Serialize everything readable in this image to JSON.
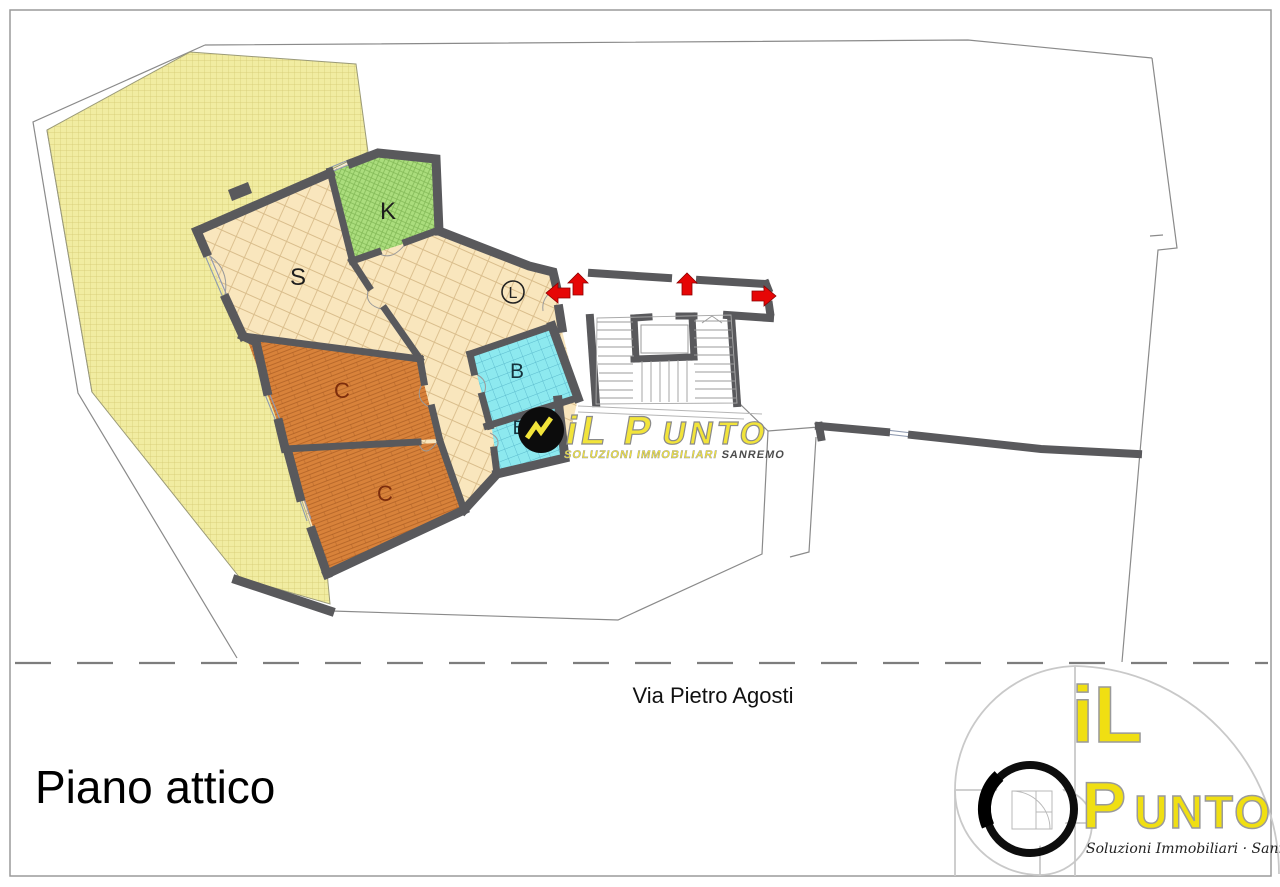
{
  "page": {
    "title": "Piano attico",
    "street": "Via Pietro Agosti"
  },
  "plan": {
    "colors": {
      "wall": "#59595c",
      "outline": "#8a8a8a",
      "arrow": "#e60606",
      "hall": "#f9e6bd"
    },
    "rooms": [
      {
        "id": "terrace",
        "label": "",
        "color": "#f1eca1",
        "label_color": "#333333"
      },
      {
        "id": "soggiorno",
        "label": "S",
        "color": "#f9e6bd",
        "label_color": "#1d1d1d"
      },
      {
        "id": "cucina",
        "label": "K",
        "color": "#abdd7d",
        "label_color": "#1d1d1d"
      },
      {
        "id": "camera-1",
        "label": "C",
        "color": "#d8823a",
        "label_color": "#7c2d0c"
      },
      {
        "id": "camera-2",
        "label": "C",
        "color": "#d8823a",
        "label_color": "#7c2d0c"
      },
      {
        "id": "bagno-1",
        "label": "B",
        "color": "#8de9ef",
        "label_color": "#15333d"
      },
      {
        "id": "bagno-2",
        "label": "B",
        "color": "#8de9ef",
        "label_color": "#15333d"
      }
    ],
    "elevator_label": "L"
  },
  "watermark": {
    "brand_a": "iL P",
    "brand_b": "UNTO",
    "sub_a": "SOLUZIONI IMMOBILIARI ",
    "sub_b": "SANREMO",
    "yellow": "#f2e43a"
  },
  "logo": {
    "word1": "iL",
    "word2_a": "P",
    "word2_b": "UNTO",
    "tagline": "Soluzioni Immobiliari · Sanremo",
    "yellow": "#f0df12"
  }
}
